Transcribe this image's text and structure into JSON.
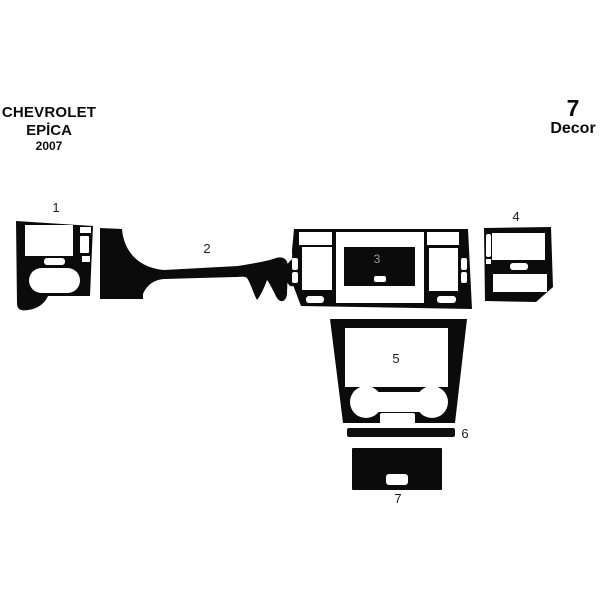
{
  "header": {
    "brand": "CHEVROLET",
    "model": "EPİCA",
    "year": "2007"
  },
  "badge": {
    "count": "7",
    "label": "Decor"
  },
  "pieces": [
    {
      "label": "1"
    },
    {
      "label": "2"
    },
    {
      "label": "3"
    },
    {
      "label": "4"
    },
    {
      "label": "5"
    },
    {
      "label": "6"
    },
    {
      "label": "7"
    }
  ],
  "colors": {
    "ink": "#0b0b0b",
    "background": "#ffffff",
    "center_label_gray": "#999999"
  }
}
